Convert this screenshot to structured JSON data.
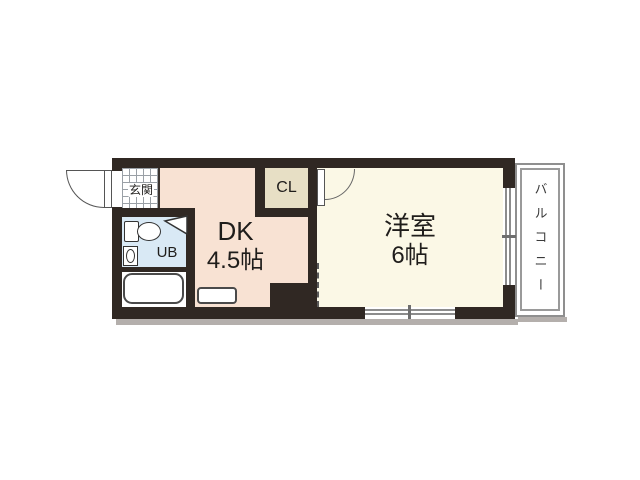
{
  "floorplan": {
    "type": "japanese-apartment-1dk",
    "rooms": {
      "genkan": {
        "label": "玄関"
      },
      "ub": {
        "label": "UB"
      },
      "dk": {
        "name": "DK",
        "size": "4.5帖"
      },
      "cl": {
        "label": "CL"
      },
      "western": {
        "name": "洋室",
        "size": "6帖"
      },
      "balcony": {
        "label": "バルコニー"
      }
    },
    "colors": {
      "wall": "#302823",
      "dk_fill": "#f8e2d3",
      "western_fill": "#fbf8e6",
      "cl_fill": "#e7dfc5",
      "ub_fill": "#d9e9f5",
      "window_gray": "#8c8c8c",
      "balcony_border": "#8f8f8f",
      "shadow": "#b4afac",
      "background": "#ffffff"
    }
  }
}
